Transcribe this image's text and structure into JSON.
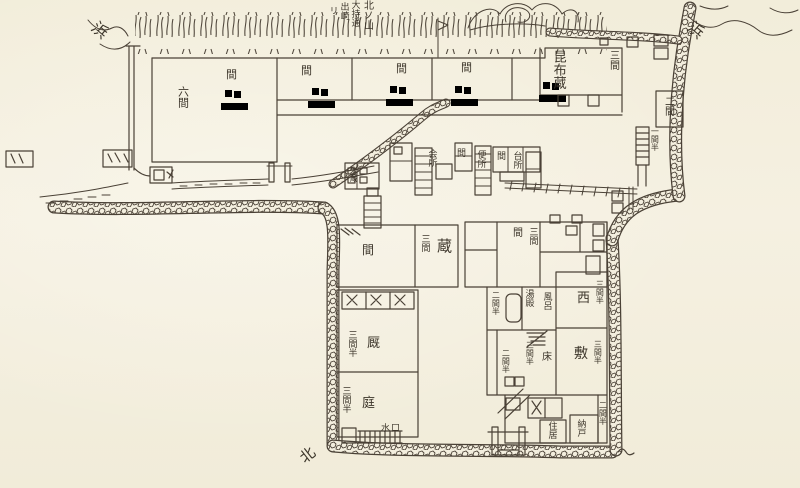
{
  "colors": {
    "paper": "#f3eede",
    "ink": "#4a4136"
  },
  "labels": {
    "hama_left": "浜",
    "ann_ri": "リ",
    "ann_desaki": "出崎",
    "ann_omochi": "大持通",
    "ann_kitanoyama": "北ノ山",
    "rokken": "六間",
    "ma_1": "間",
    "ma_2": "間",
    "ma_3": "間",
    "ma_4": "間",
    "konbugura": "昆布蔵",
    "sangen_porch": "三間",
    "niken_east": "二間",
    "ikkenhan_stairs": "一間半",
    "hama_right": "浜",
    "kaisho": "会所",
    "ma_mid_1": "間",
    "benjo": "便所",
    "ma_mid_2": "間",
    "daidokoro": "台所",
    "komegura": "米蔵",
    "ma_lower": "間",
    "sangen_kura": "三間",
    "kura": "蔵",
    "sangenhan_umaya": "三間半",
    "umaya": "厩",
    "sangenhan_niwa": "三間半",
    "niwa": "庭",
    "sangen_house": "三間",
    "ma_house": "間",
    "nikenhan_bath": "二間半",
    "yudono": "湯殿",
    "furo": "風呂",
    "nishi": "西",
    "sangenhan_west": "三間半",
    "shiki": "敷",
    "sangenhan_center": "三間半",
    "toko": "床",
    "nikenhan_center": "二間半",
    "sangenhan_south": "三間半",
    "juukyo": "住居",
    "nando": "納戸",
    "nikenhan_se": "二間半",
    "mizuguchi": "水口",
    "kita": "北"
  }
}
